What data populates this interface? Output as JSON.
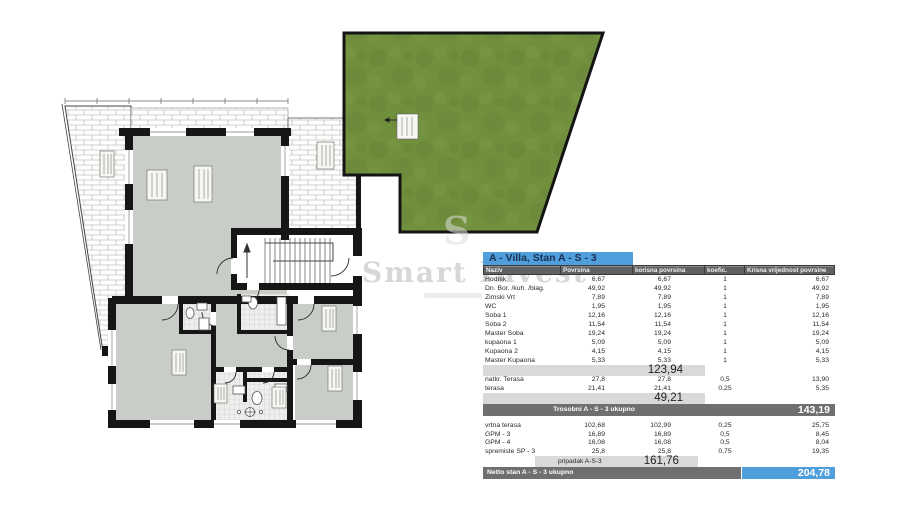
{
  "watermark": {
    "brand": "Smart Invest",
    "reg": "®",
    "letter": "S"
  },
  "table": {
    "title": "A - Villa, Stan A - S - 3",
    "columns": [
      "Naziv",
      "Povrsina",
      "korisna povrsina",
      "koefic.",
      "Krisna vrijednost povrsine"
    ],
    "rooms": [
      [
        "Hodnik",
        "6,67",
        "6,67",
        "1",
        "6,67"
      ],
      [
        "Dn. Bor. /kuh. /blag.",
        "49,92",
        "49,92",
        "1",
        "49,92"
      ],
      [
        "Zimski Vrt",
        "7,89",
        "7,89",
        "1",
        "7,89"
      ],
      [
        "WC",
        "1,95",
        "1,95",
        "1",
        "1,95"
      ],
      [
        "Soba 1",
        "12,16",
        "12,16",
        "1",
        "12,16"
      ],
      [
        "Soba 2",
        "11,54",
        "11,54",
        "1",
        "11,54"
      ],
      [
        "Master Soba",
        "19,24",
        "19,24",
        "1",
        "19,24"
      ],
      [
        "kupaona 1",
        "5,09",
        "5,09",
        "1",
        "5,09"
      ],
      [
        "Kupaona 2",
        "4,15",
        "4,15",
        "1",
        "4,15"
      ],
      [
        "Master Kupaona",
        "5,33",
        "5,33",
        "1",
        "5,33"
      ]
    ],
    "subtotal_rooms": "123,94",
    "terraces": [
      [
        "natkr. Terasa",
        "27,8",
        "27,8",
        "0,5",
        "13,90"
      ],
      [
        "terasa",
        "21,41",
        "21,41",
        "0,25",
        "5,35"
      ]
    ],
    "subtotal_terraces": "49,21",
    "total_trosobni": {
      "label": "Trosobni  A - S - 3 ukupno",
      "value": "143,19"
    },
    "extras": [
      [
        "vrtna terasa",
        "102,68",
        "102,99",
        "0,25",
        "25,75"
      ],
      [
        "GPM - 3",
        "16,89",
        "16,89",
        "0,5",
        "8,45"
      ],
      [
        "GPM - 4",
        "16,08",
        "16,08",
        "0,5",
        "8,04"
      ],
      [
        "spremiste SP - 3",
        "25,8",
        "25,8",
        "0,75",
        "19,35"
      ]
    ],
    "subtotal_extras": {
      "label": "pripadak A-S-3",
      "value": "161,76"
    },
    "total_netto": {
      "label": "Netto stan A - S - 3 ukupno",
      "value": "204,78"
    }
  },
  "colors": {
    "accent_blue": "#4e9fdb",
    "header_gray": "#616161",
    "total_bar_gray": "#6f6f6f",
    "subtotal_gray": "#d9d9d9",
    "grass_green": "#71903e",
    "room_gray": "#c9cdc8",
    "wall_black": "#161616",
    "title_text": "#1c2f52"
  }
}
